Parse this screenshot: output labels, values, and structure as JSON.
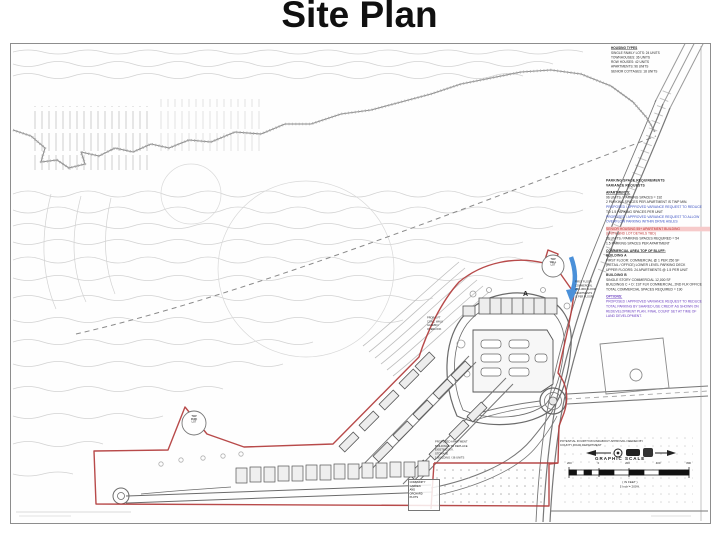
{
  "slide": {
    "title": "Site Plan"
  },
  "colors": {
    "boundary_red": "#b23b3b",
    "flow_arrow_blue": "#4a90d9",
    "note_blue": "#3a50c2",
    "note_red": "#c03434",
    "note_red_highlight_bg": "#f6caca",
    "note_purple": "#6b3fc0"
  },
  "sheet": {
    "housing_types": {
      "lines": [
        "HOUSING TYPES",
        "SINGLE FAMILY LOTS: 24 UNITS",
        "TOWNHOUSES: 36 UNITS",
        "ROW HOUSES: 42 UNITS",
        "APARTMENTS: 96 UNITS",
        "SENIOR COTTAGES: 18 UNITS"
      ]
    },
    "notes": {
      "heading": [
        "PARKING SPACE REQUIREMENTS",
        "VARIANCE REQUESTS"
      ],
      "apartments": {
        "label": "APARTMENTS:",
        "lines": [
          "96 UNITS / PARKING SPACES = 192",
          "2 PARKING SPACES PER APARTMENT IS TWP MIN.",
          "TO 1.5 PARKING SPACES PER UNIT"
        ],
        "blue": [
          "PROPOSED / APPROVED VARIANCE REQUEST TO REDUCE",
          "PROPOSED / APPROVED VARIANCE REQUEST TO ALLOW",
          "OVERFLOW PARKING WITHIN DRIVE AISLES"
        ]
      },
      "senior": {
        "red": [
          "SENIOR HOUSING 55+ APARTMENT BUILDING",
          "(UNITS AND LOT DETAILS TBD)"
        ],
        "black": [
          "36 UNITS / PARKING SPACES REQUIRED = 54",
          "1.5 PARKING SPACES PER APARTMENT"
        ]
      },
      "commercial": {
        "label": "COMMERCIAL AREA TOP OF BLUFF:",
        "lines": [
          "BUILDING A",
          "FIRST FLOOR: COMMERCIAL @ 1 PER 250 SF",
          "(RETAIL / OFFICE) LOWER LEVEL PARKING DECK",
          "UPPER FLOORS: 24 APARTMENTS @ 1.5 PER UNIT",
          "BUILDING B",
          "SINGLE STORY COMMERCIAL 12,000 SF",
          "BUILDINGS C + D: 1ST FLR COMMERCIAL, 2ND FLR OFFICE",
          "TOTAL COMMERCIAL SPACES REQUIRED = 190"
        ]
      },
      "options": {
        "purple": [
          "OPTIONS:",
          "PROPOSED / APPROVED VARIANCE REQUEST TO REDUCE",
          "TOTAL PARKING BY SHARED USE CREDIT AS SHOWN ON",
          "REDEVELOPMENT PLAN. FINAL COUNT SET AT TIME OF",
          "LAND DEVELOPMENT."
        ]
      }
    },
    "roundabout_note": {
      "lines": [
        "POTENTIAL FOURTH ROUNDABOUT APPROVAL NEEDED BY",
        "COUNTY ROAD DEPARTMENT"
      ]
    },
    "apartment_note": {
      "lines": [
        "PROPOSED APARTMENT",
        "BUILDINGS TO REPLACE",
        "EXISTING R.V.",
        "STORAGE",
        "1 BUILDING / 36 UNITS"
      ]
    },
    "garden_note": {
      "lines": [
        "COMMUNITY",
        "GARDEN",
        "AND",
        "ORCHARD",
        "PLOTS"
      ]
    },
    "gazebo_note": {
      "lines": [
        "PROP. 6 FT",
        "CONC. WALK",
        "GAZEBO /",
        "OVERLOOK"
      ]
    },
    "mixed_use_note": {
      "lines": [
        "FIRST FLOOR",
        "COMMERCIAL",
        "2ND-3RD FLOOR",
        "APARTMENTS",
        "(2 PER FLOOR)"
      ]
    },
    "badge_park": {
      "lines": [
        "TWP",
        "PARK",
        "LOT"
      ]
    },
    "badge_well": {
      "lines": [
        "TWP",
        "WELL",
        "LOT"
      ]
    },
    "building_label_a": "A",
    "scale": {
      "title": "GRAPHIC SCALE",
      "ticks": [
        "200",
        "0",
        "200",
        "400",
        "800"
      ],
      "in_feet": "( IN FEET )",
      "ratio": "1 Inch = 200 ft."
    }
  }
}
